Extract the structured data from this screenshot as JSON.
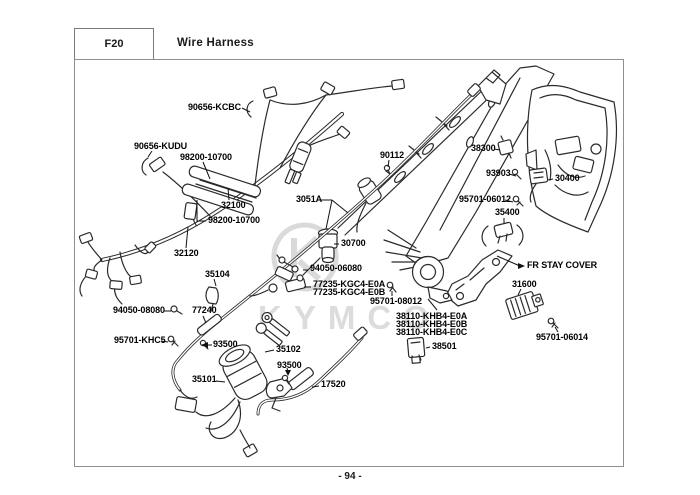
{
  "header": {
    "section_code": "F20",
    "title": "Wire Harness"
  },
  "footer": {
    "page_number": "- 94 -"
  },
  "watermark": {
    "brand": "KYMCO"
  },
  "colors": {
    "background": "#ffffff",
    "line_art": "#2b2b2b",
    "page_border": "#8f8f8f",
    "label_text": "#000000",
    "watermark_gray": "#dcdcdc"
  },
  "part_labels": [
    {
      "part_number": "90656-KCBC"
    },
    {
      "part_number": "90656-KUDU"
    },
    {
      "part_number": "98200-10700"
    },
    {
      "part_number": "32100"
    },
    {
      "part_number": "98200-10700"
    },
    {
      "part_number": "32120"
    },
    {
      "part_number": "35104"
    },
    {
      "part_number": "90112"
    },
    {
      "part_number": "3051A"
    },
    {
      "part_number": "30700"
    },
    {
      "part_number": "38300"
    },
    {
      "part_number": "93903"
    },
    {
      "part_number": "30400"
    },
    {
      "part_number": "95701-06012"
    },
    {
      "part_number": "35400"
    },
    {
      "part_number": "FR STAY COVER"
    },
    {
      "part_number": "31600"
    },
    {
      "part_number": "95701-06014"
    },
    {
      "part_number": "94050-06080"
    },
    {
      "part_number": "77235-KGC4-E0A"
    },
    {
      "part_number": "77235-KGC4-E0B"
    },
    {
      "part_number": "95701-08012"
    },
    {
      "part_number": "38110-KHB4-E0A"
    },
    {
      "part_number": "38110-KHB4-E0B"
    },
    {
      "part_number": "38110-KHB4-E0C"
    },
    {
      "part_number": "38501"
    },
    {
      "part_number": "94050-08080"
    },
    {
      "part_number": "77240"
    },
    {
      "part_number": "95701-KHC5"
    },
    {
      "part_number": "93500"
    },
    {
      "part_number": "35102"
    },
    {
      "part_number": "93500"
    },
    {
      "part_number": "35101"
    },
    {
      "part_number": "17520"
    }
  ]
}
